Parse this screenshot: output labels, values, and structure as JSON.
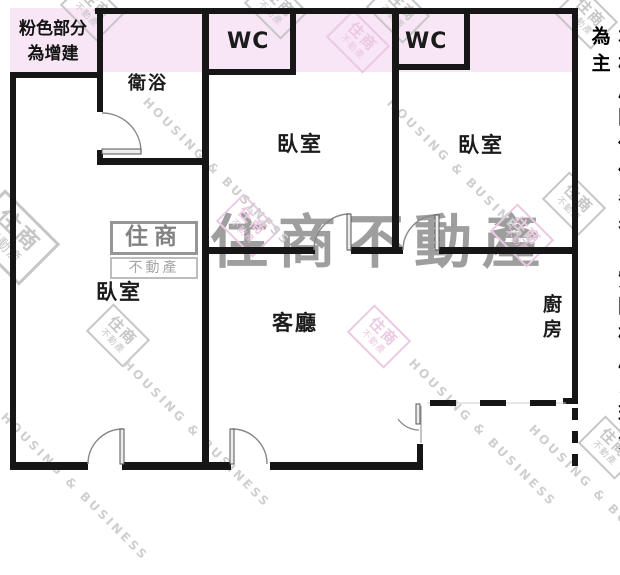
{
  "note": {
    "text": "粉色部分\n為增建"
  },
  "disclaimer": {
    "text": "本格局圖僅供參考，實際格局以現況為主"
  },
  "rooms": {
    "bathroom": "衛浴",
    "wc_left": "WC",
    "wc_right": "WC",
    "bedroom_middle": "臥室",
    "bedroom_right": "臥室",
    "bedroom_left": "臥室",
    "living_room": "客廳",
    "kitchen": "廚房"
  },
  "watermarks": {
    "brand_large": "住商不動產",
    "logo_primary": "住商",
    "logo_secondary": "不動產",
    "slogan": "HOUSING & BUSINESS"
  },
  "colors": {
    "addition_pink": "#f8e5f5",
    "wall_black": "#161616",
    "door_gray": "#777777",
    "stamp_gray": "#c6c6c6",
    "stamp_pink": "#ecc9e2",
    "brand_gray": "#919191"
  }
}
